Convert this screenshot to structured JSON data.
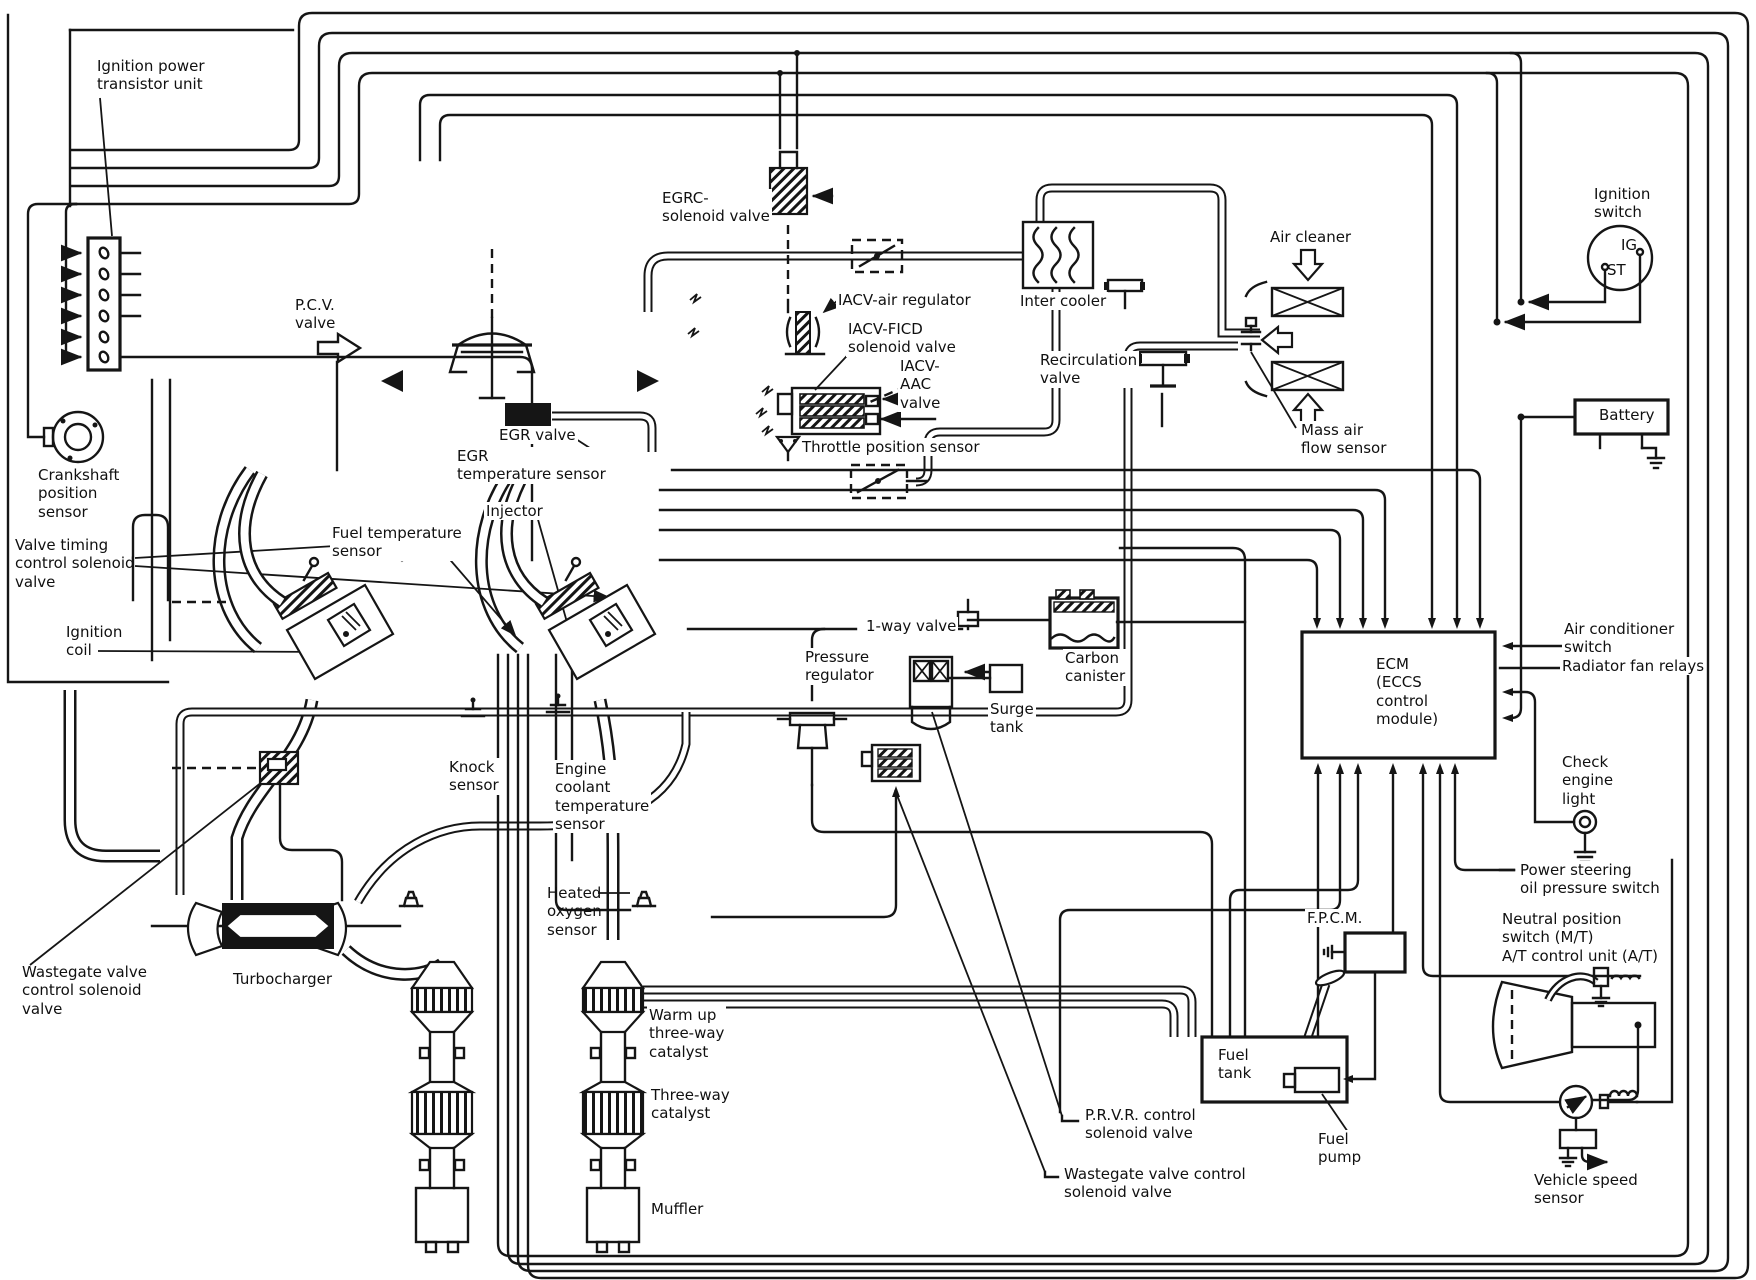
{
  "document": {
    "kind": "engine-control-vacuum-and-wiring-diagram",
    "colors": {
      "ink": "#151515",
      "paper": "#ffffff"
    }
  },
  "labels": {
    "ignition_power_transistor_unit": "Ignition power\ntransistor unit",
    "crankshaft_position_sensor": "Crankshaft\nposition\nsensor",
    "valve_timing_control_solenoid_valve": "Valve timing\ncontrol solenoid\nvalve",
    "ignition_coil": "Ignition\ncoil",
    "wastegate_valve_control_solenoid_valve_left": "Wastegate valve\ncontrol solenoid\nvalve",
    "turbocharger": "Turbocharger",
    "pcv_valve": "P.C.V.\nvalve",
    "egr_valve": "EGR valve",
    "egr_temperature_sensor": "EGR\ntemperature sensor",
    "fuel_temperature_sensor": "Fuel temperature\nsensor",
    "injector": "Injector",
    "egrc_solenoid_valve": "EGRC-\nsolenoid valve",
    "iacv_air_regulator": "IACV-air regulator",
    "iacv_ficd_solenoid_valve": "IACV-FICD\nsolenoid valve",
    "iacv_aac_valve": "IACV-\nAAC\nvalve",
    "throttle_position_sensor": "Throttle position sensor",
    "inter_cooler": "Inter cooler",
    "recirculation_valve": "Recirculation\nvalve",
    "air_cleaner": "Air cleaner",
    "mass_air_flow_sensor": "Mass air\nflow sensor",
    "ignition_switch": "Ignition\nswitch",
    "ignition_switch_ig": "IG",
    "ignition_switch_st": "ST",
    "battery": "Battery",
    "one_way_valve": "1-way valve",
    "pressure_regulator": "Pressure\nregulator",
    "surge_tank": "Surge\ntank",
    "carbon_canister": "Carbon\ncanister",
    "ecm": "ECM\n(ECCS\ncontrol\nmodule)",
    "air_conditioner_switch": "Air conditioner\nswitch",
    "radiator_fan_relays": "Radiator fan relays",
    "check_engine_light": "Check\nengine\nlight",
    "power_steering_oil_pressure_switch": "Power steering\noil pressure switch",
    "neutral_position_switch": "Neutral position\nswitch (M/T)\nA/T control unit (A/T)",
    "knock_sensor": "Knock\nsensor",
    "engine_coolant_temperature_sensor": "Engine\ncoolant\ntemperature\nsensor",
    "heated_oxygen_sensor": "Heated\noxygen\nsensor",
    "warm_up_three_way_catalyst": "Warm up\nthree-way\ncatalyst",
    "three_way_catalyst": "Three-way\ncatalyst",
    "muffler": "Muffler",
    "fpcm": "F.P.C.M.",
    "fuel_tank": "Fuel\ntank",
    "fuel_pump": "Fuel\npump",
    "prvr_control_solenoid_valve": "P.R.V.R. control\nsolenoid valve",
    "wastegate_valve_control_solenoid_valve_bottom": "Wastegate valve control\nsolenoid valve",
    "vehicle_speed_sensor": "Vehicle speed\nsensor"
  }
}
